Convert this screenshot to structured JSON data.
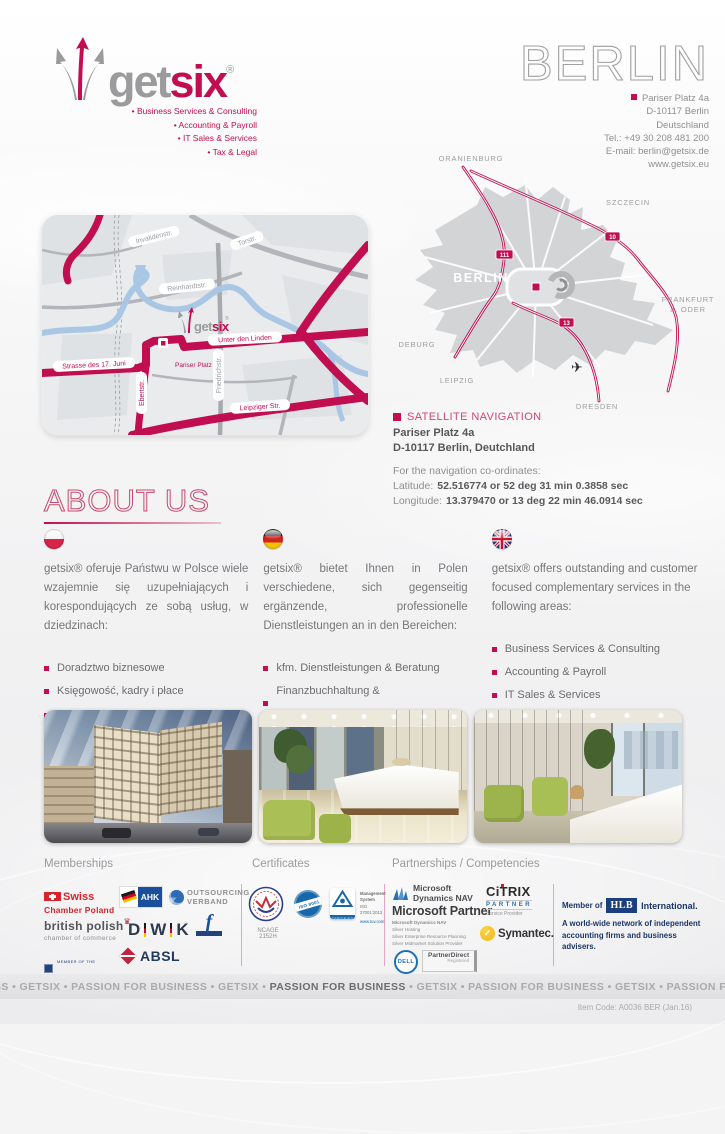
{
  "theme": {
    "accent": "#c10e50",
    "pink_heading": "#cf4a70",
    "gray_text": "#8f8f91",
    "navy": "#1b3668"
  },
  "header": {
    "brand": {
      "get": "get",
      "six": "six",
      "reg": "®",
      "taglines": [
        "• Business Services & Consulting",
        "• Accounting & Payroll",
        "• IT Sales & Services",
        "• Tax & Legal"
      ]
    },
    "city_title": "BERLIN",
    "address": {
      "line1": "Pariser Platz 4a",
      "line2": "D-10117 Berlin",
      "line3": "Deutschland",
      "line4": "Tel.: +49 30 208 481 200",
      "line5": "E-mail: berlin@getsix.de",
      "line6": "www.getsix.eu"
    }
  },
  "street_map": {
    "labels": {
      "invalidenstr": "Invalidenstr.",
      "torstr": "Torstr.",
      "reinhardtstr": "Reinhardtstr.",
      "strasse17": "Strasse des 17. Juni",
      "pariser_platz": "Pariser Platz",
      "unter_den_linden": "Unter den Linden",
      "ebertstr": "Ebertstr.",
      "friedrichstr": "Friedrichstr.",
      "leipziger": "Leipziger Str."
    },
    "logo": {
      "get": "get",
      "six": "six",
      "reg": "®"
    }
  },
  "region_map": {
    "cities": {
      "oranienburg": "ORANIENBURG",
      "szczecin": "SZCZECIN",
      "frankfurt_l1": "FRANKFURT",
      "frankfurt_l2": "a. ODER",
      "deburg": "DEBURG",
      "leipzig": "LEIPZIG",
      "dresden": "DRESDEN",
      "berlin": "BERLIN"
    },
    "badges": {
      "b111": "111",
      "b10": "10",
      "b13": "13"
    },
    "airplane": "✈"
  },
  "satnav": {
    "title": "SATELLITE NAVIGATION",
    "addr1": "Pariser Platz 4a",
    "addr2": "D-10117 Berlin, Deutchland",
    "intro": "For the navigation co-ordinates:",
    "lat_label": "Latitude:",
    "lat_value": "52.516774 or 52 deg 31 min 0.3858 sec",
    "lon_label": "Longitude:",
    "lon_value": "13.379470 or 13 deg 22 min 46.0914 sec"
  },
  "about": {
    "title": "ABOUT US",
    "columns": [
      {
        "intro": "getsix® oferuje Państwu w Polsce wiele wzajemnie się uzupełniających i korespondujących ze sobą usług, w dziedzinach:",
        "bullets": [
          "Doradztwo biznesowe",
          "Księgowość, kadry i płace",
          "Sprzedaż i serwis IT",
          "Doradztwo podatkowe i prawne"
        ]
      },
      {
        "intro": "getsix® bietet Ihnen in Polen verschiedene, sich gegenseitig ergänzende, professionelle Dienstleistungen an in den Bereichen:",
        "bullets": [
          "kfm. Dienstleistungen & Beratung",
          "Finanzbuchhaltung & Personalabrechnung",
          "IT Vertrieb & Services",
          "Steuer & Rechtsberatung"
        ]
      },
      {
        "intro": "getsix® offers outstanding and customer focused complementary services in the following areas:",
        "bullets": [
          "Business Services & Consulting",
          "Accounting & Payroll",
          "IT Sales & Services",
          "Tax & Legal"
        ]
      }
    ]
  },
  "logos": {
    "memberships_title": "Memberships",
    "certificates_title": "Certificates",
    "partnerships_title": "Partnerships / Competencies",
    "swiss_l1": "Swiss",
    "swiss_l2": "Chamber Poland",
    "ahk": "AHK",
    "outsourcing_l1": "OUTSOURCING",
    "outsourcing_l2": "VERBAND",
    "bp_l1": "british polish",
    "bp_l2": "chamber of commerce",
    "crown": "♛",
    "dwk_d": "D",
    "dwk_w": "W",
    "dwk_k": "K",
    "europa_f": "f",
    "forum_small": "MEMBER OF THE",
    "forum_main": "FORUM OF FIRMS",
    "absl": "ABSL",
    "ncage": "NCAGE 2152H",
    "iso": "ISO 9001",
    "tuv_cert": "CERTIFIED",
    "tuv_l1": "Management System",
    "tuv_l2": "ISO 27001:2013",
    "tuv_l3": "www.tuv.com",
    "ms_l1": "Microsoft",
    "ms_l2": "Dynamics NAV",
    "ms_partner": "Microsoft Partner",
    "ms_sub": [
      "Microsoft Dynamics NAV",
      "Silver Hosting",
      "Silver Enterprise Resource Planning",
      "Silver Midmarket Solution Provider"
    ],
    "dell": "DELL",
    "pd_main": "PartnerDirect",
    "pd_sub": "Registered",
    "citrix": "CiTRIX",
    "citrix_partner": "PARTNER",
    "citrix_sub": "Service Provider",
    "symantec_check": "✓",
    "symantec": "Symantec.",
    "hlb_member": "Member of",
    "hlb": "HLB",
    "hlb_intl": "International.",
    "hlb_d1": "A world-wide network of independent",
    "hlb_d2": "accounting firms and business advisers."
  },
  "footer": {
    "band_pre": "SS • GETSIX • PASSION FOR BUSINESS • GETSIX • ",
    "band_bold": "PASSION FOR BUSINESS",
    "band_post": " • GETSIX • PASSION FOR BUSINESS • GETSIX • PASSION FOR BUSINESS • GETSIX • PASSION FOR BUSINESS",
    "item_code": "Item Code: A0036 BER (Jan.16)"
  }
}
